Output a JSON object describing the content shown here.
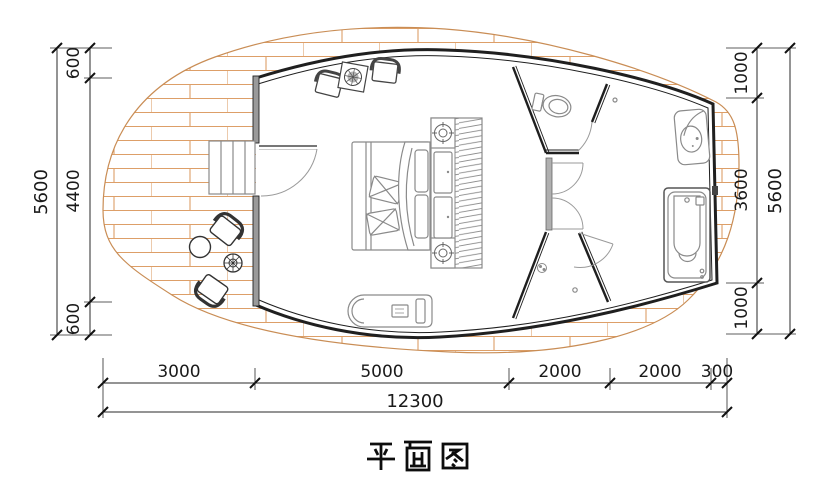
{
  "title": "平面图",
  "dims": {
    "left_total": "5600",
    "left_segments": [
      "600",
      "4400",
      "600"
    ],
    "right_segments": [
      "1000",
      "3600",
      "1000"
    ],
    "right_total": "5600",
    "bottom_segments": [
      "3000",
      "5000",
      "2000",
      "2000",
      "300"
    ],
    "bottom_total": "12300"
  },
  "colors": {
    "plank_line": "#dd9f68",
    "deck_edge": "#c98d55",
    "wall": "#1f1f1f",
    "partition_gray": "#9a9a9a",
    "furniture_line": "#8a8a8a",
    "dimension_line": "#2a2a2a",
    "text": "#111111"
  },
  "fixtures": [
    "wood-deck",
    "entry-steps",
    "entry-door",
    "armchair",
    "side-table-with-plant",
    "double-bed",
    "wardrobe",
    "ceiling-light",
    "chaise-lounge",
    "toilet",
    "interior-doors",
    "shower",
    "floor-drain",
    "washbasin",
    "bathtub",
    "outdoor-chair",
    "outdoor-round-table",
    "outdoor-tea-table"
  ]
}
